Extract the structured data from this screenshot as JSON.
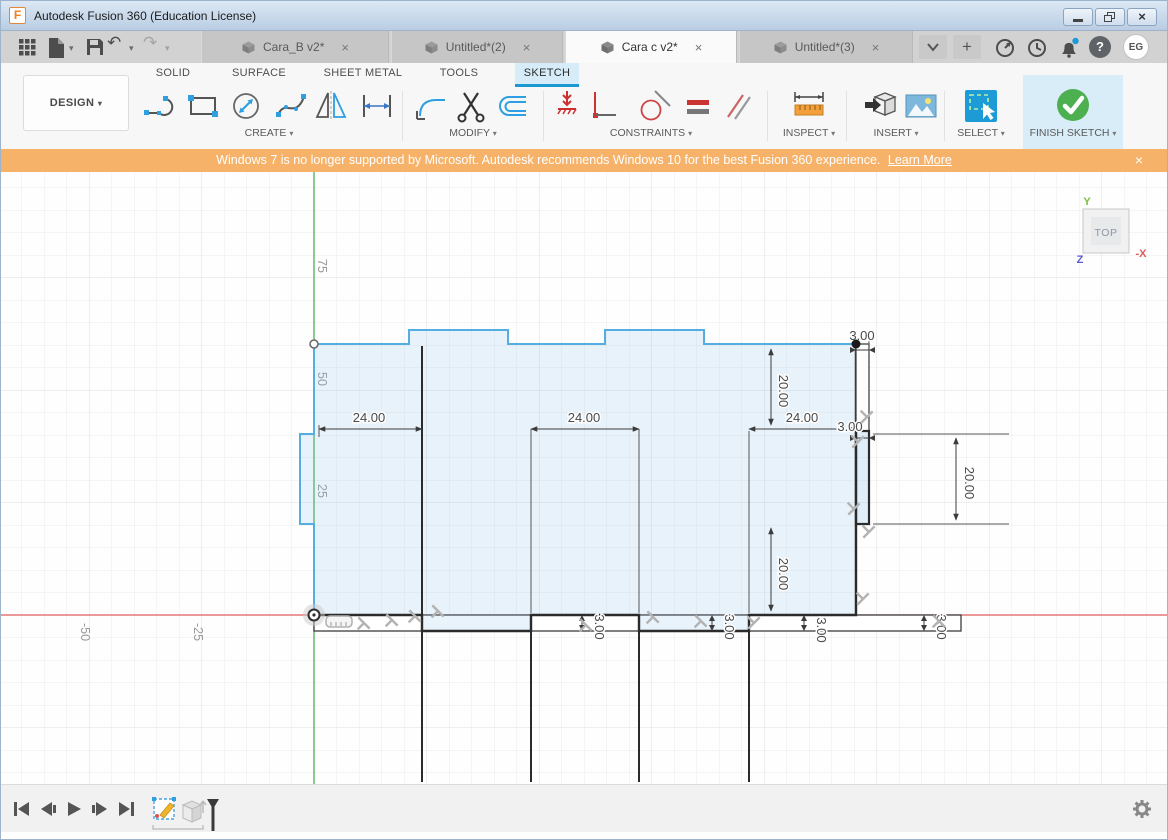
{
  "titlebar": {
    "app_title": "Autodesk Fusion 360 (Education License)"
  },
  "glyphs": {
    "caret": "▾",
    "plus": "+",
    "close": "×",
    "undo": "↶",
    "redo": "↷",
    "question": "?"
  },
  "doc_tabs": [
    {
      "label": "Cara_B v2*"
    },
    {
      "label": "Untitled*(2)"
    },
    {
      "label": "Cara c v2*"
    },
    {
      "label": "Untitled*(3)"
    }
  ],
  "account": {
    "initials": "EG"
  },
  "ribbon": {
    "workspace": "DESIGN",
    "tabs": [
      {
        "label": "SOLID"
      },
      {
        "label": "SURFACE"
      },
      {
        "label": "SHEET METAL"
      },
      {
        "label": "TOOLS"
      },
      {
        "label": "SKETCH"
      }
    ],
    "groups": {
      "create": "CREATE",
      "modify": "MODIFY",
      "constraints": "CONSTRAINTS",
      "inspect": "INSPECT",
      "insert": "INSERT",
      "select": "SELECT",
      "finish": "FINISH SKETCH"
    }
  },
  "banner": {
    "message": "Windows 7 is no longer supported by Microsoft. Autodesk recommends Windows 10 for the best Fusion 360 experience.",
    "link": "Learn More"
  },
  "viewcube": {
    "face": "TOP",
    "axis_y": "Y",
    "axis_z": "Z",
    "axis_x": "-X"
  },
  "canvas": {
    "y_ticks": [
      "75",
      "50",
      "25"
    ],
    "x_ticks": [
      "-50",
      "-25"
    ],
    "dims": {
      "width": [
        "24.00",
        "24.00",
        "24.00"
      ],
      "height": [
        "20.00",
        "20.00",
        "20.00"
      ],
      "thickness": [
        "3.00",
        "3.00",
        "3.00",
        "3.00",
        "3.00",
        "3.00"
      ]
    }
  },
  "colors": {
    "accent_blue": "#1d9bd7",
    "sketch_line_blue": "#54aee2",
    "profile_black": "#2b2b2b",
    "banner_orange": "#f7b26a",
    "finish_green": "#4caf50",
    "axis_red": "#e05b5b",
    "axis_green": "#5fb35f"
  }
}
